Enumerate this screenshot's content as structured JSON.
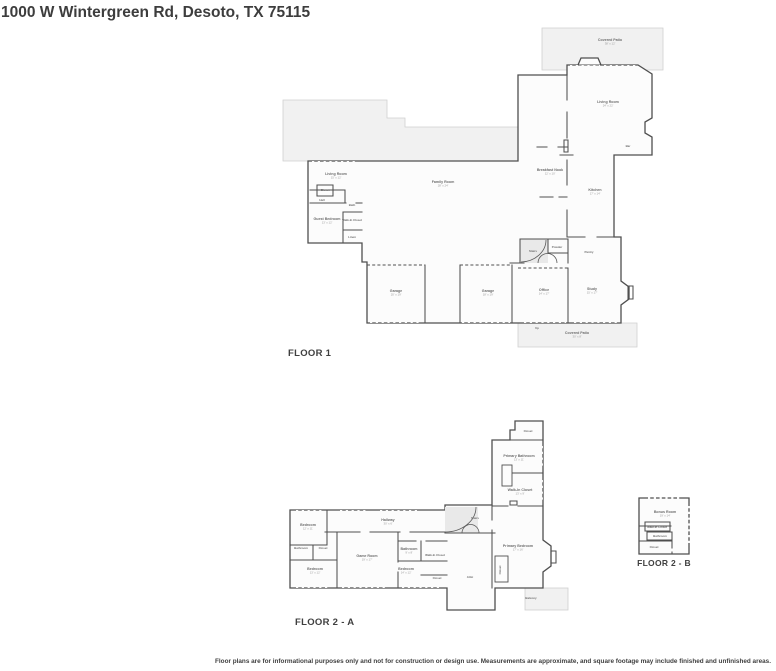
{
  "title": "1000 W Wintergreen Rd, Desoto, TX 75115",
  "footer": "Floor plans are for informational purposes only and not for construction or design use. Measurements are approximate, and square footage may include finished and unfinished areas.",
  "colors": {
    "wall": "#4f4f4f",
    "patio_fill": "#f1f1f1",
    "floor_fill": "#fcfcfc",
    "heading_text": "#3d3d3d",
    "room_text": "#6e6e6e",
    "dims_text": "#9b9b9b"
  },
  "floors": [
    {
      "id": "floor1",
      "label": "FLOOR 1",
      "rooms": [
        {
          "n": "Covered Patio",
          "d": "38' x 12'",
          "x": 610,
          "y": 41
        },
        {
          "n": "Living Room",
          "d": "24' x 22'",
          "x": 608,
          "y": 103
        },
        {
          "n": "Bar",
          "x": 628,
          "y": 147,
          "t": true
        },
        {
          "n": "Breakfast Nook",
          "d": "12' x 10'",
          "x": 550,
          "y": 171
        },
        {
          "n": "Kitchen",
          "d": "17' x 14'",
          "x": 595,
          "y": 191
        },
        {
          "n": "Family Room",
          "d": "28' x 24'",
          "x": 443,
          "y": 183
        },
        {
          "n": "Living Room",
          "d": "15' x 12'",
          "x": 336,
          "y": 175
        },
        {
          "n": "Closet",
          "x": 325,
          "y": 191,
          "t": true
        },
        {
          "n": "Hall",
          "x": 322,
          "y": 201,
          "t": true
        },
        {
          "n": "Guest Bedroom",
          "d": "13' x 12'",
          "x": 327,
          "y": 220
        },
        {
          "n": "Bath",
          "x": 352,
          "y": 206,
          "t": true
        },
        {
          "n": "Walk-In Closet",
          "x": 352,
          "y": 221,
          "t": true
        },
        {
          "n": "Linen",
          "x": 352,
          "y": 238,
          "t": true
        },
        {
          "n": "Stairs",
          "x": 533,
          "y": 252,
          "t": true
        },
        {
          "n": "Powder",
          "x": 557,
          "y": 248,
          "t": true
        },
        {
          "n": "Pantry",
          "x": 589,
          "y": 253,
          "t": true
        },
        {
          "n": "Garage",
          "d": "20' x 19'",
          "x": 396,
          "y": 292
        },
        {
          "n": "Garage",
          "d": "18' x 19'",
          "x": 488,
          "y": 292
        },
        {
          "n": "Office",
          "d": "14' x 17'",
          "x": 544,
          "y": 291
        },
        {
          "n": "Study",
          "d": "15' x 17'",
          "x": 592,
          "y": 290
        },
        {
          "n": "Up",
          "x": 537,
          "y": 329,
          "t": true
        },
        {
          "n": "Covered Patio",
          "d": "30' x 8'",
          "x": 577,
          "y": 334
        }
      ]
    },
    {
      "id": "floor2a",
      "label": "FLOOR 2 - A",
      "rooms": [
        {
          "n": "Closet",
          "x": 528,
          "y": 432,
          "t": true
        },
        {
          "n": "Primary Bathroom",
          "d": "13' x 11'",
          "x": 519,
          "y": 457
        },
        {
          "n": "Walk-In Closet",
          "d": "13' x 9'",
          "x": 520,
          "y": 491
        },
        {
          "n": "Stairs",
          "x": 475,
          "y": 519,
          "t": true
        },
        {
          "n": "Hallway",
          "d": "30' x 6'",
          "x": 388,
          "y": 521
        },
        {
          "n": "Bedroom",
          "d": "12' x 11'",
          "x": 308,
          "y": 526
        },
        {
          "n": "Bathroom",
          "x": 301,
          "y": 549,
          "t": true
        },
        {
          "n": "Closet",
          "x": 323,
          "y": 549,
          "t": true
        },
        {
          "n": "Bedroom",
          "d": "13' x 12'",
          "x": 315,
          "y": 570
        },
        {
          "n": "Game Room",
          "d": "19' x 17'",
          "x": 367,
          "y": 557
        },
        {
          "n": "Bathroom",
          "d": "9' x 8'",
          "x": 409,
          "y": 550
        },
        {
          "n": "Walk-In Closet",
          "x": 435,
          "y": 556,
          "t": true
        },
        {
          "n": "Bedroom",
          "d": "14' x 12'",
          "x": 406,
          "y": 570
        },
        {
          "n": "Closet",
          "x": 437,
          "y": 579,
          "t": true
        },
        {
          "n": "Attic",
          "x": 470,
          "y": 578,
          "t": true
        },
        {
          "n": "Primary Bedroom",
          "d": "17' x 16'",
          "x": 518,
          "y": 547
        },
        {
          "n": "Closet",
          "x": 501,
          "y": 570,
          "t": true,
          "v": true
        },
        {
          "n": "Balcony",
          "x": 531,
          "y": 599,
          "t": true
        }
      ]
    },
    {
      "id": "floor2b",
      "label": "FLOOR 2 - B",
      "rooms": [
        {
          "n": "Bonus Room",
          "d": "19' x 14'",
          "x": 665,
          "y": 513
        },
        {
          "n": "Walk-In Closet",
          "x": 657,
          "y": 528,
          "t": true
        },
        {
          "n": "Bathroom",
          "x": 660,
          "y": 537,
          "t": true
        },
        {
          "n": "Closet",
          "x": 654,
          "y": 548,
          "t": true
        }
      ]
    }
  ]
}
